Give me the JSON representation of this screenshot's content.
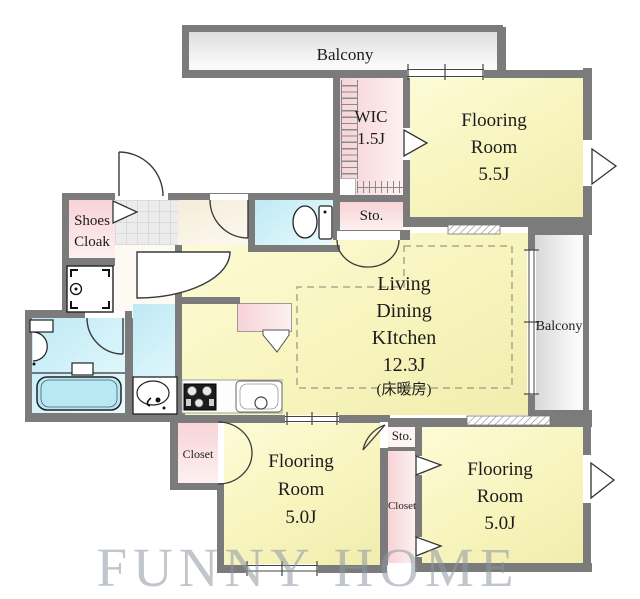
{
  "plan": {
    "watermark": "FUNNY HOME",
    "rooms": {
      "balcony_top": {
        "label": "Balcony"
      },
      "wic": {
        "lines": [
          "WIC",
          "1.5J"
        ]
      },
      "flooring_55": {
        "lines": [
          "Flooring",
          "Room",
          "5.5J"
        ]
      },
      "sto_top": {
        "label": "Sto."
      },
      "shoes_cloak": {
        "lines": [
          "Shoes",
          "Cloak"
        ]
      },
      "ldk": {
        "lines": [
          "Living",
          "Dining",
          "KItchen",
          "12.3J"
        ],
        "note": "(床暖房)"
      },
      "balcony_right": {
        "label": "Balcony"
      },
      "closet_left": {
        "label": "Closet"
      },
      "flooring_50_left": {
        "lines": [
          "Flooring",
          "Room",
          "5.0J"
        ]
      },
      "sto_bottom": {
        "label": "Sto."
      },
      "closet_mid": {
        "label": "Closet"
      },
      "flooring_50_right": {
        "lines": [
          "Flooring",
          "Room",
          "5.0J"
        ]
      }
    },
    "colors": {
      "wall": "#7b7b7b",
      "room_yellow": "#f7f4bd",
      "closet_pink": "#f7d3d7",
      "wet_area_cyan": "#bfe9f4",
      "hall_beige": "#f5ecd8",
      "balcony_gray": "#dedede",
      "bathtub_cyan": "#b8e9f3",
      "floor_heating_dash": "#9a9a85",
      "watermark_gray": "#8d98a4"
    }
  }
}
